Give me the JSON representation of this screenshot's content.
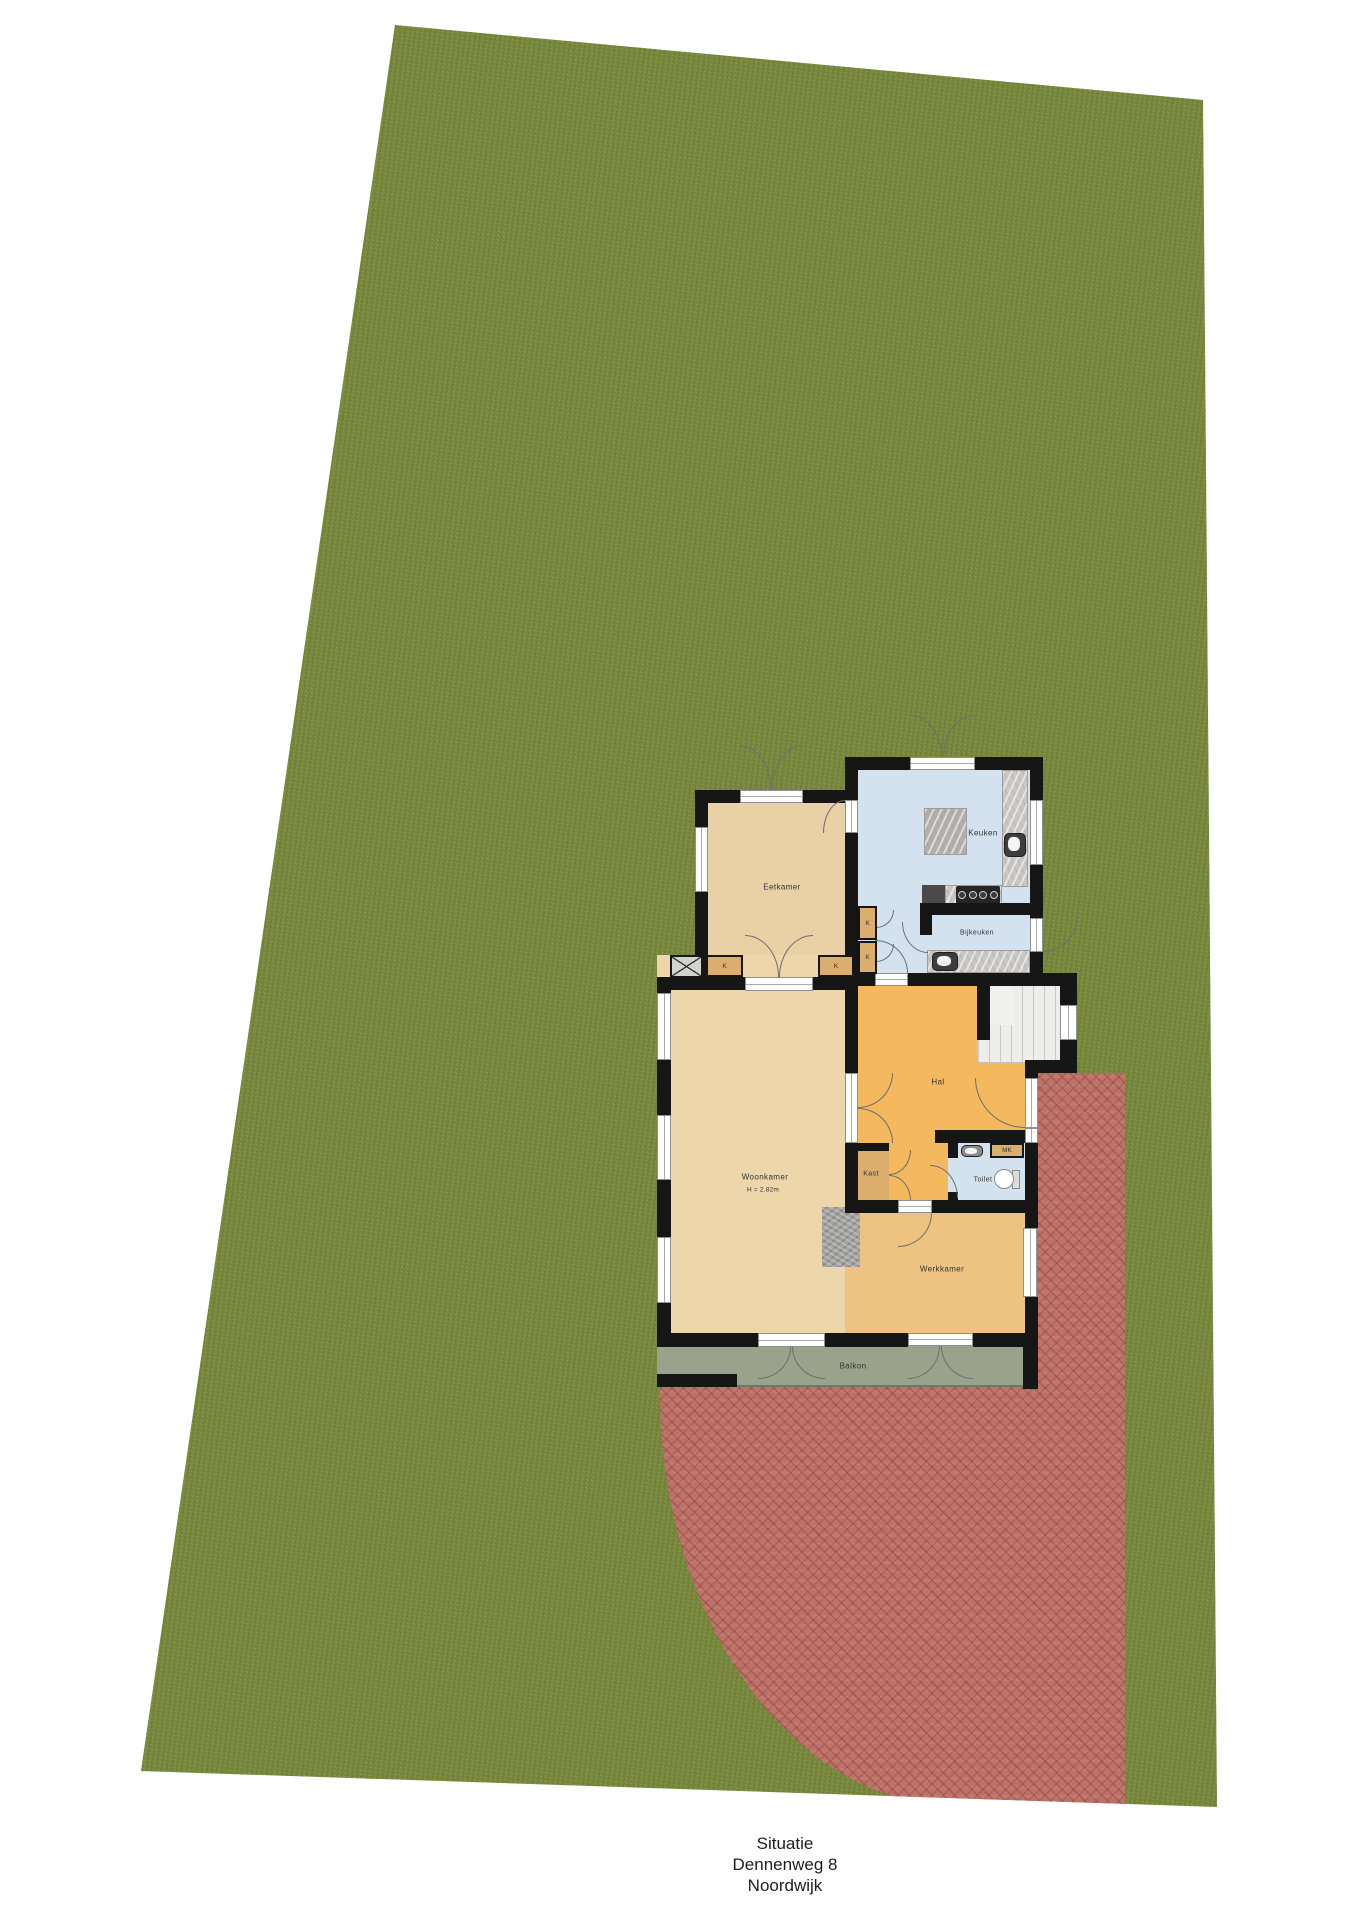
{
  "floorplan": {
    "rooms": {
      "eetkamer": "Eetkamer",
      "keuken": "Keuken",
      "bijkeuken": "Bijkeuken",
      "hal": "Hal",
      "woonkamer": "Woonkamer",
      "woonkamer_height": "H = 2.82m",
      "kast": "Kast",
      "toilet": "Toilet",
      "mk": "MK",
      "werkkamer": "Werkkamer",
      "balkon": "Balkon",
      "closet": "K"
    },
    "fixtures": [
      "kitchen-island",
      "kitchen-counter",
      "kitchen-sink",
      "cooktop",
      "utility-counter",
      "utility-sink",
      "toilet-bowl",
      "toilet-sink",
      "fireplace",
      "staircase"
    ],
    "colors": {
      "grass": "#7C8C42",
      "patio_brick": "#BD7269",
      "walls": "#161616",
      "eetkamer_floor": "#E9D0A5",
      "woonkamer_floor": "#EED6AB",
      "keuken_floor": "#D4E2EF",
      "hal_floor": "#F4B95F",
      "werkkamer_floor": "#EEC381",
      "closet_fill": "#DCAE6E",
      "balkon_floor": "#9AA28B",
      "stairs": "#EDEDEC"
    }
  },
  "caption": {
    "title": "Situatie",
    "address": "Dennenweg 8",
    "city": "Noordwijk"
  }
}
